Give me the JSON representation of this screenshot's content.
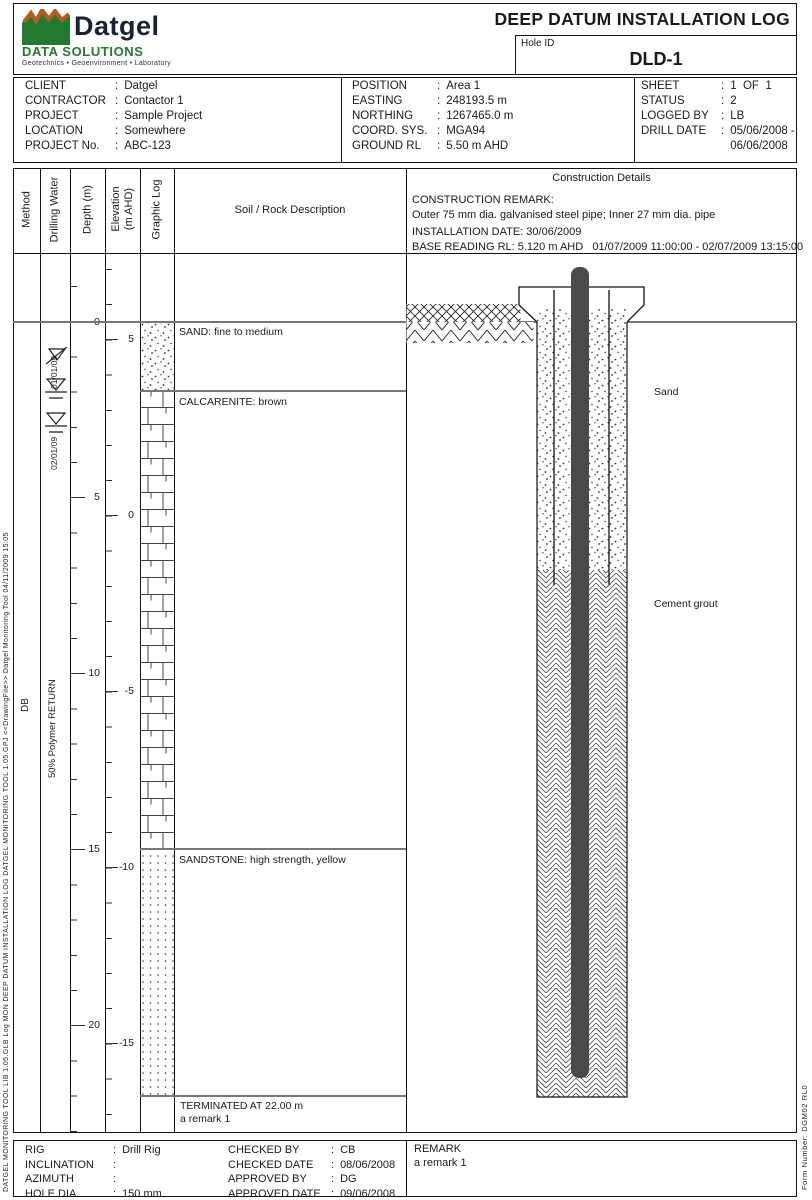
{
  "punct": {
    "colon": ":"
  },
  "header": {
    "title": "DEEP DATUM INSTALLATION LOG",
    "hole_id_label": "Hole ID",
    "hole_id": "DLD-1",
    "logo_name": "Datgel",
    "logo_subtitle": "DATA SOLUTIONS",
    "logo_tagline": "Geotechnics • Geoenvironment • Laboratory",
    "logo_green": "#217a2e",
    "logo_orange": "#b85c1e"
  },
  "project_info": {
    "col1": [
      {
        "label": "CLIENT",
        "value": "Datgel"
      },
      {
        "label": "CONTRACTOR",
        "value": "Contactor 1"
      },
      {
        "label": "PROJECT",
        "value": "Sample Project"
      },
      {
        "label": "LOCATION",
        "value": "Somewhere"
      },
      {
        "label": "PROJECT No.",
        "value": "ABC-123"
      }
    ],
    "col2": [
      {
        "label": "POSITION",
        "value": "Area 1"
      },
      {
        "label": "EASTING",
        "value": "248193.5 m"
      },
      {
        "label": "NORTHING",
        "value": "1267465.0 m"
      },
      {
        "label": "COORD. SYS.",
        "value": "MGA94"
      },
      {
        "label": "GROUND RL",
        "value": "5.50 m AHD"
      }
    ],
    "col3": [
      {
        "label": "SHEET",
        "value": "1  OF  1"
      },
      {
        "label": "STATUS",
        "value": "2"
      },
      {
        "label": "LOGGED BY",
        "value": "LB"
      },
      {
        "label": "DRILL DATE",
        "value": "05/06/2008 -"
      },
      {
        "label": "",
        "value": "06/06/2008"
      }
    ]
  },
  "log_header": {
    "method": "Method",
    "drilling_water": "Drilling Water",
    "depth": "Depth (m)",
    "elevation": "Elevation\n(m AHD)",
    "graphic_log": "Graphic Log",
    "description": "Soil / Rock Description",
    "construction": "Construction Details",
    "remark_title": "CONSTRUCTION REMARK:",
    "remark_text": "Outer 75 mm dia. galvanised steel pipe; Inner 27 mm dia. pipe",
    "installation_date": "INSTALLATION DATE: 30/06/2009",
    "base_reading": "BASE READING RL: 5.120 m AHD   01/07/2009 11:00:00 - 02/07/2009 13:15:00"
  },
  "log_body": {
    "method_code": "DB",
    "water_return": "50% Polymer RETURN",
    "water_levels": [
      {
        "date": "01/01/09"
      },
      {
        "date": "02/01/09"
      }
    ],
    "depth_scale": [
      "0",
      "5",
      "10",
      "15",
      "20"
    ],
    "elevation_scale": [
      "5",
      "0",
      "-5",
      "-10",
      "-15"
    ],
    "strata": [
      {
        "description": "SAND: fine to medium",
        "depth_from": 0.0,
        "depth_to": 2.0,
        "pattern": "sand-stipple"
      },
      {
        "description": "CALCARENITE: brown",
        "depth_from": 2.0,
        "depth_to": 15.0,
        "pattern": "limestone-brick"
      },
      {
        "description": "SANDSTONE: high strength, yellow",
        "depth_from": 15.0,
        "depth_to": 22.0,
        "pattern": "dot-grid"
      }
    ],
    "termination_line1": "TERMINATED AT 22.00 m",
    "termination_line2": "a remark 1",
    "construction_labels": {
      "backfill_upper": "Sand",
      "backfill_lower": "Cement grout"
    }
  },
  "footer": {
    "col1": [
      {
        "label": "RIG",
        "value": "Drill Rig"
      },
      {
        "label": "INCLINATION",
        "value": ""
      },
      {
        "label": "AZIMUTH",
        "value": ""
      },
      {
        "label": "HOLE DIA.",
        "value": "150 mm"
      }
    ],
    "col2": [
      {
        "label": "CHECKED BY",
        "value": "CB"
      },
      {
        "label": "CHECKED DATE",
        "value": "08/06/2008"
      },
      {
        "label": "APPROVED BY",
        "value": "DG"
      },
      {
        "label": "APPROVED DATE",
        "value": "09/06/2008"
      }
    ],
    "remark_label": "REMARK",
    "remark_value": "a remark 1"
  },
  "side_text_left": "DATGEL MONITORING TOOL LIB 1.05.GLB  Log  MON DEEP DATUM INSTALLATION LOG  DATGEL MONITORING TOOL 1.05.GPJ  <<DrawingFile>>  Datgel Monitoring Tool 04/11/2009 15:05",
  "side_text_right": "Form Number:  DGM02 RL0"
}
